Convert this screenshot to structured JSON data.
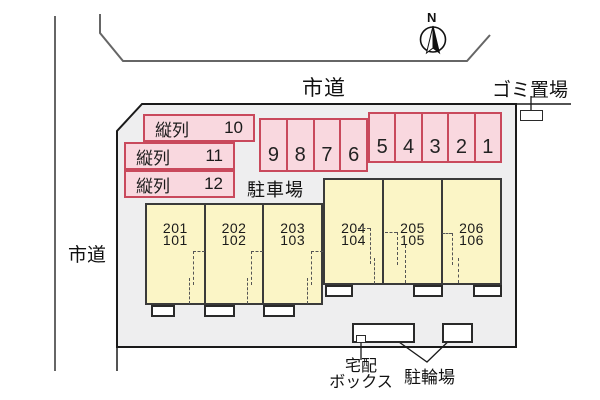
{
  "labels": {
    "road_top": "市道",
    "road_left": "市道",
    "garbage": "ゴミ置場",
    "parking_area": "駐車場",
    "delivery_line1": "宅配",
    "delivery_line2": "ボックス",
    "bicycle": "駐輪場",
    "north": "N"
  },
  "tandem_spaces": [
    {
      "label": "縦列",
      "number": "10"
    },
    {
      "label": "縦列",
      "number": "11"
    },
    {
      "label": "縦列",
      "number": "12"
    }
  ],
  "parking_stalls": {
    "back_row": [
      "9",
      "8",
      "7",
      "6"
    ],
    "front_row": [
      "5",
      "4",
      "3",
      "2",
      "1"
    ]
  },
  "units": {
    "left_building": [
      {
        "upper": "201",
        "lower": "101"
      },
      {
        "upper": "202",
        "lower": "102"
      },
      {
        "upper": "203",
        "lower": "103"
      }
    ],
    "right_building": [
      {
        "upper": "204",
        "lower": "104"
      },
      {
        "upper": "205",
        "lower": "105"
      },
      {
        "upper": "206",
        "lower": "106"
      }
    ]
  },
  "colors": {
    "parking_fill": "#F9D8DF",
    "parking_border": "#C9495C",
    "building_fill": "#FBF5C6",
    "building_border": "#3A3A3A",
    "site_fill": "#EEEEEF",
    "site_border": "#1A1A1A",
    "road_line": "#666666"
  }
}
